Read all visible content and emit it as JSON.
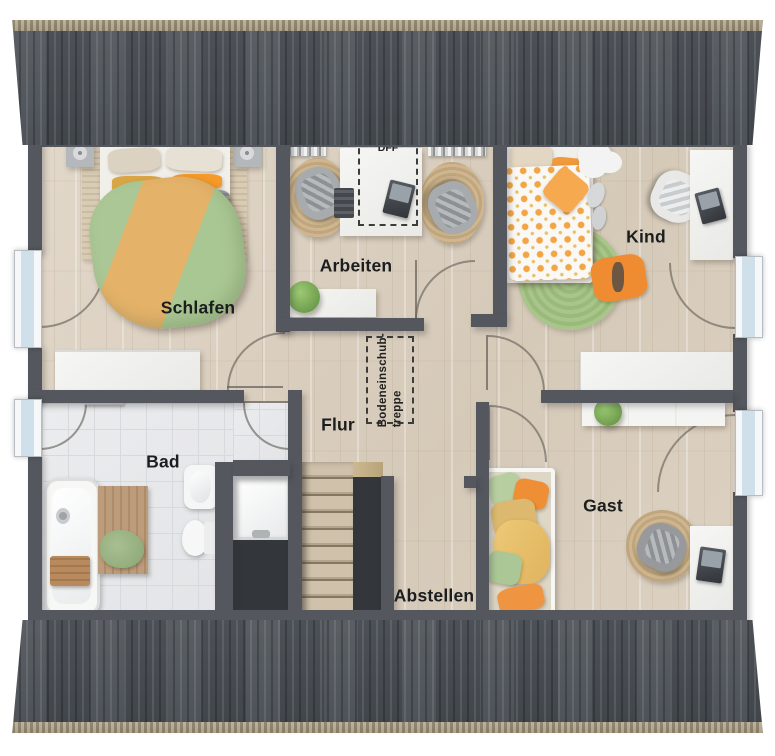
{
  "floorplan": {
    "rooms": [
      {
        "id": "schlafen",
        "label": "Schlafen"
      },
      {
        "id": "arbeiten",
        "label": "Arbeiten"
      },
      {
        "id": "kind",
        "label": "Kind"
      },
      {
        "id": "flur",
        "label": "Flur"
      },
      {
        "id": "bad",
        "label": "Bad"
      },
      {
        "id": "abstellen",
        "label": "Abstellen"
      },
      {
        "id": "gast",
        "label": "Gast"
      }
    ],
    "annotations": {
      "roof_window_label": "DFF",
      "attic_stairs_line1": "Bodeneinschub-",
      "attic_stairs_line2": "treppe"
    },
    "colors": {
      "wall": "#54585e",
      "roof": "#4b5056",
      "roof_edge": "#b2a68b",
      "wood_floor": "#dcd1c2",
      "bath_tile": "#e9eaec",
      "window_glass": "#cfe0ea",
      "accent_orange": "#f0913a",
      "accent_green": "#a9c794",
      "rug_jute": "#cbb28b",
      "rug_green": "#a2c083"
    }
  }
}
